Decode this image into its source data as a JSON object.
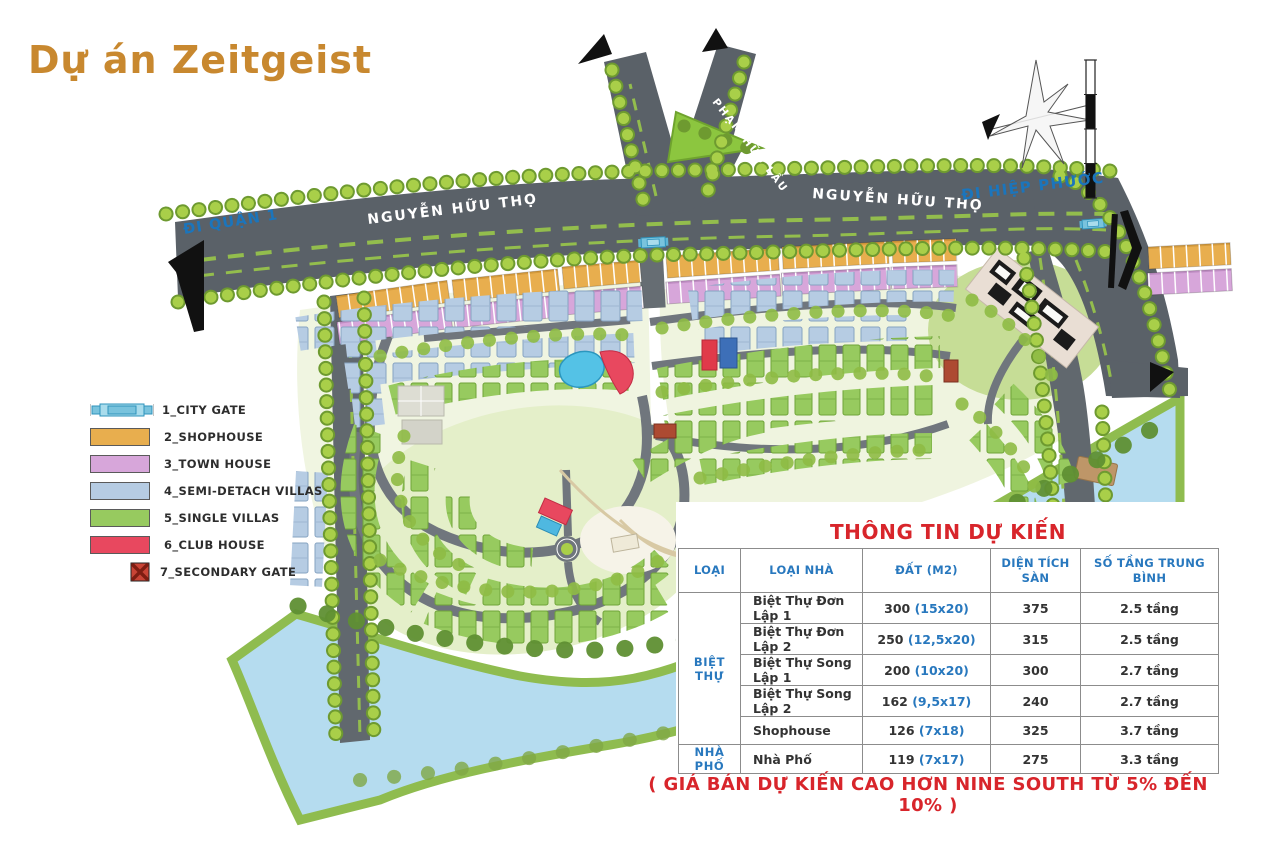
{
  "title": "Dự án Zeitgeist",
  "map": {
    "roads": {
      "nguyen_huu_tho_west": "NGUYỄN HỮU THỌ",
      "nguyen_huu_tho_east": "NGUYỄN HỮU THỌ",
      "pham_huu_lau": "PHẠM HỮU LẦU"
    },
    "directions": {
      "west": "ĐI QUẬN 1",
      "east": "ĐI HIỆP PHƯỚC"
    }
  },
  "legend": {
    "items": [
      {
        "label": "1_CITY GATE",
        "icon": "city-gate-icon",
        "color": "#79C3DD"
      },
      {
        "label": "2_SHOPHOUSE",
        "icon": "swatch",
        "color": "#E8AE4E"
      },
      {
        "label": "3_TOWN HOUSE",
        "icon": "swatch",
        "color": "#D7A6DA"
      },
      {
        "label": "4_SEMI-DETACH VILLAS",
        "icon": "swatch",
        "color": "#B6CCE3"
      },
      {
        "label": "5_SINGLE VILLAS",
        "icon": "swatch",
        "color": "#97CA5F"
      },
      {
        "label": "6_CLUB HOUSE",
        "icon": "swatch",
        "color": "#E8485F"
      },
      {
        "label": "7_SECONDARY GATE",
        "icon": "secondary-gate-icon",
        "color": "#B03E2E"
      }
    ]
  },
  "info_table": {
    "title": "THÔNG TIN DỰ KIẾN",
    "columns": [
      "LOẠI",
      "LOẠI NHÀ",
      "ĐẤT (M2)",
      "DIỆN TÍCH SÀN",
      "SỐ TẦNG TRUNG BÌNH"
    ],
    "groups": [
      {
        "name": "BIỆT THỰ",
        "rows": [
          {
            "house_type": "Biệt Thự Đơn Lập 1",
            "land_area": "300",
            "land_dims": "(15x20)",
            "floor_area": "375",
            "floors": "2.5 tầng"
          },
          {
            "house_type": "Biệt Thự Đơn Lập 2",
            "land_area": "250",
            "land_dims": "(12,5x20)",
            "floor_area": "315",
            "floors": "2.5 tầng"
          },
          {
            "house_type": "Biệt Thự Song Lập 1",
            "land_area": "200",
            "land_dims": "(10x20)",
            "floor_area": "300",
            "floors": "2.7 tầng"
          },
          {
            "house_type": "Biệt Thự Song Lập 2",
            "land_area": "162",
            "land_dims": "(9,5x17)",
            "floor_area": "240",
            "floors": "2.7 tầng"
          },
          {
            "house_type": "Shophouse",
            "land_area": "126",
            "land_dims": "(7x18)",
            "floor_area": "325",
            "floors": "3.7 tầng"
          }
        ]
      },
      {
        "name": "NHÀ PHỐ",
        "rows": [
          {
            "house_type": "Nhà Phố",
            "land_area": "119",
            "land_dims": "(7x17)",
            "floor_area": "275",
            "floors": "3.3 tầng"
          }
        ]
      }
    ]
  },
  "caption": "( GIÁ BÁN DỰ KIẾN CAO HƠN NINE SOUTH TỪ 5% ĐẾN 10% )",
  "colors": {
    "title": "#C8882F",
    "table_header_blue": "#2878BE",
    "red_accent": "#D8252B",
    "road": "#5A6168",
    "river": "#B5DCEF",
    "tree": "#A9CF49",
    "shophouse": "#E8AE4E",
    "townhouse": "#D7A6DA",
    "semi_detach": "#B6CCE3",
    "single_villa": "#97CA5F",
    "club_house": "#E8485F",
    "secondary_gate": "#B03E2E"
  }
}
